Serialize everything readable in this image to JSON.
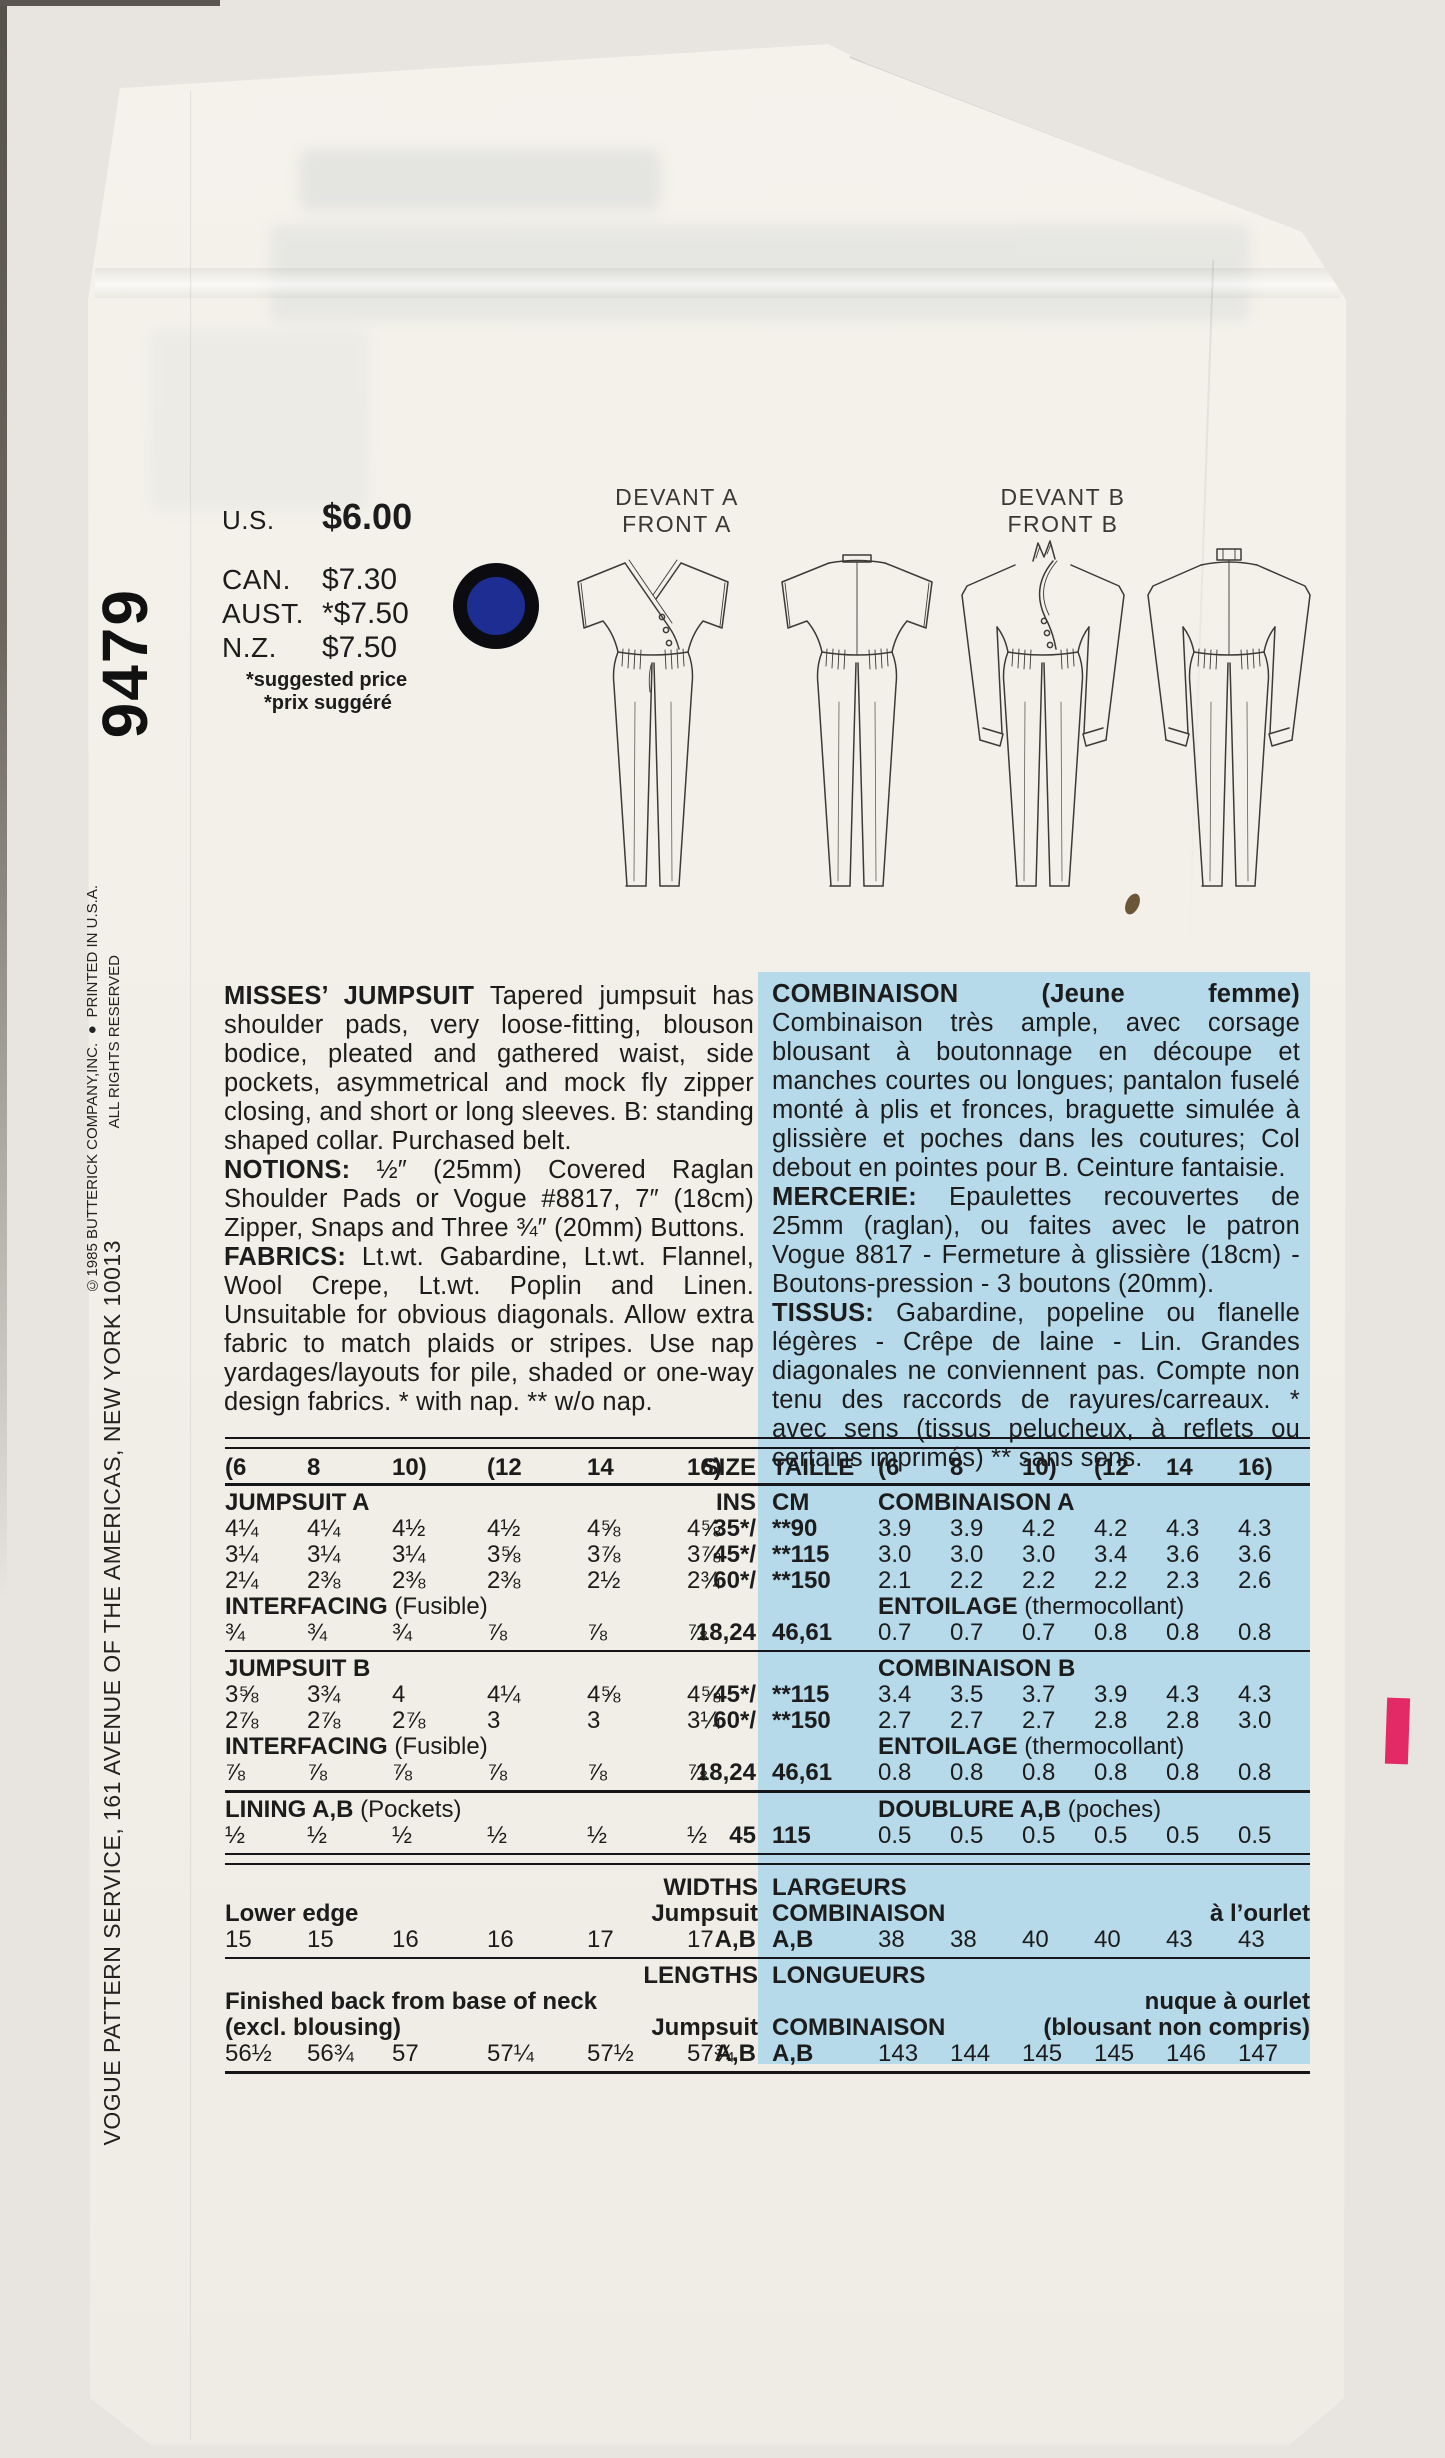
{
  "colors": {
    "scan_bg": "#e8e5e0",
    "paper": "#f2efe8",
    "blue_panel": "#b6daea",
    "ink": "#1c1c1c",
    "dot_blue": "#1d2d92",
    "pink_mark": "#e32a67"
  },
  "pattern": {
    "number": "9479"
  },
  "side": {
    "address": "VOGUE PATTERN SERVICE, 161 AVENUE OF THE AMERICAS, NEW YORK 10013",
    "copyright": "©1985 BUTTERICK COMPANY,INC. ● PRINTED IN U.S.A.",
    "rights": "ALL RIGHTS RESERVED"
  },
  "prices": {
    "us_label": "U.S.",
    "us": "$6.00",
    "can_label": "CAN.",
    "can": "$7.30",
    "aust_label": "AUST.",
    "aust": "*$7.50",
    "nz_label": "N.Z.",
    "nz": "$7.50",
    "note_en": "*suggested price",
    "note_fr": "*prix suggéré"
  },
  "figures": {
    "front_a_fr": "DEVANT A",
    "front_a_en": "FRONT A",
    "front_b_fr": "DEVANT B",
    "front_b_en": "FRONT B"
  },
  "description_en": {
    "p1_lead": "MISSES’ JUMPSUIT",
    "p1_text": " Tapered jumpsuit has shoulder pads, very loose-fitting, blouson bodice, pleated and gathered waist, side pockets, asymmetrical and mock fly zipper closing, and short or long sleeves. B: standing shaped collar. Purchased belt.",
    "p2_lead": "NOTIONS:",
    "p2_text": " ½″ (25mm) Covered Raglan Shoulder Pads or Vogue #8817, 7″ (18cm) Zipper, Snaps and Three ¾″ (20mm) Buttons.",
    "p3_lead": "FABRICS:",
    "p3_text": " Lt.wt. Gabardine, Lt.wt. Flannel, Wool Crepe, Lt.wt. Poplin and Linen. Unsuitable for obvious diagonals. Allow extra fabric to match plaids or stripes. Use nap yardages/layouts for pile, shaded or one-way design fabrics. * with nap. ** w/o nap."
  },
  "description_fr": {
    "p1_lead": "COMBINAISON (Jeune femme)",
    "p1_text": " Combinaison très ample, avec corsage blousant à boutonnage en découpe et manches courtes ou longues; pantalon fuselé monté à plis et fronces, braguette simulée à glissière et poches dans les coutures; Col debout en pointes pour B. Ceinture fantaisie.",
    "p2_lead": "MERCERIE:",
    "p2_text": " Epaulettes recouvertes de 25mm (raglan), ou faites avec le patron Vogue 8817 - Fermeture à glissière (18cm) - Boutons-pression - 3 boutons (20mm).",
    "p3_lead": "TISSUS:",
    "p3_text": " Gabardine, popeline ou flanelle légères - Crêpe de laine - Lin. Grandes diagonales ne conviennent pas. Compte non tenu des raccords de rayures/carreaux. * avec sens (tissus pelucheux, à reflets ou certains imprimés) ** sans sens."
  },
  "table": {
    "header": {
      "sizes_left": [
        "(6",
        "8",
        "10)",
        "(12",
        "14",
        "16)"
      ],
      "size_label": "SIZE",
      "taille_label": "TAILLE",
      "sizes_right": [
        "(6",
        "8",
        "10)",
        "(12",
        "14",
        "16)"
      ]
    },
    "jumpsuit_a": {
      "label_en": "JUMPSUIT A",
      "unit_en": "INS",
      "unit_fr": "CM",
      "label_fr": "COMBINAISON A",
      "rows": [
        {
          "ins": [
            "4¼",
            "4¼",
            "4½",
            "4½",
            "4⅝",
            "4⅝"
          ],
          "size": "35*/",
          "cm_size": "**90",
          "cm": [
            "3.9",
            "3.9",
            "4.2",
            "4.2",
            "4.3",
            "4.3"
          ]
        },
        {
          "ins": [
            "3¼",
            "3¼",
            "3¼",
            "3⅝",
            "3⅞",
            "3⅞"
          ],
          "size": "45*/",
          "cm_size": "**115",
          "cm": [
            "3.0",
            "3.0",
            "3.0",
            "3.4",
            "3.6",
            "3.6"
          ]
        },
        {
          "ins": [
            "2¼",
            "2⅜",
            "2⅜",
            "2⅜",
            "2½",
            "2¾"
          ],
          "size": "60*/",
          "cm_size": "**150",
          "cm": [
            "2.1",
            "2.2",
            "2.2",
            "2.2",
            "2.3",
            "2.6"
          ]
        }
      ],
      "interfacing_en_lead": "INTERFACING",
      "interfacing_en_rest": " (Fusible)",
      "interfacing_fr_lead": "ENTOILAGE",
      "interfacing_fr_rest": " (thermocollant)",
      "interfacing_row": {
        "ins": [
          "¾",
          "¾",
          "¾",
          "⅞",
          "⅞",
          "⅞"
        ],
        "size": "18,24",
        "cm_size": "46,61",
        "cm": [
          "0.7",
          "0.7",
          "0.7",
          "0.8",
          "0.8",
          "0.8"
        ]
      }
    },
    "jumpsuit_b": {
      "label_en": "JUMPSUIT B",
      "label_fr": "COMBINAISON B",
      "rows": [
        {
          "ins": [
            "3⅝",
            "3¾",
            "4",
            "4¼",
            "4⅝",
            "4⅝"
          ],
          "size": "45*/",
          "cm_size": "**115",
          "cm": [
            "3.4",
            "3.5",
            "3.7",
            "3.9",
            "4.3",
            "4.3"
          ]
        },
        {
          "ins": [
            "2⅞",
            "2⅞",
            "2⅞",
            "3",
            "3",
            "3¼"
          ],
          "size": "60*/",
          "cm_size": "**150",
          "cm": [
            "2.7",
            "2.7",
            "2.7",
            "2.8",
            "2.8",
            "3.0"
          ]
        }
      ],
      "interfacing_en_lead": "INTERFACING",
      "interfacing_en_rest": " (Fusible)",
      "interfacing_fr_lead": "ENTOILAGE",
      "interfacing_fr_rest": " (thermocollant)",
      "interfacing_row": {
        "ins": [
          "⅞",
          "⅞",
          "⅞",
          "⅞",
          "⅞",
          "⅞"
        ],
        "size": "18,24",
        "cm_size": "46,61",
        "cm": [
          "0.8",
          "0.8",
          "0.8",
          "0.8",
          "0.8",
          "0.8"
        ]
      }
    },
    "lining": {
      "label_en_lead": "LINING A,B",
      "label_en_rest": " (Pockets)",
      "label_fr_lead": "DOUBLURE A,B",
      "label_fr_rest": " (poches)",
      "row": {
        "ins": [
          "½",
          "½",
          "½",
          "½",
          "½",
          "½"
        ],
        "size": "45",
        "cm_size": "115",
        "cm": [
          "0.5",
          "0.5",
          "0.5",
          "0.5",
          "0.5",
          "0.5"
        ]
      }
    },
    "widths": {
      "title_en": "WIDTHS",
      "title_fr": "LARGEURS",
      "row_label_en": "Lower edge",
      "garment_en": "Jumpsuit",
      "garment_fr": "COMBINAISON",
      "hem_fr": "à l’ourlet",
      "values_in": [
        "15",
        "15",
        "16",
        "16",
        "17",
        "17"
      ],
      "ab_left": "A,B",
      "ab_right": "A,B",
      "values_cm": [
        "38",
        "38",
        "40",
        "40",
        "43",
        "43"
      ]
    },
    "lengths": {
      "title_en": "LENGTHS",
      "title_fr": "LONGUEURS",
      "row_label_en1": "Finished back from base of neck",
      "row_label_en2": "(excl. blousing)",
      "garment_en": "Jumpsuit",
      "garment_fr": "COMBINAISON",
      "note_fr1": "nuque à ourlet",
      "note_fr2": "(blousant non compris)",
      "values_in": [
        "56½",
        "56¾",
        "57",
        "57¼",
        "57½",
        "57¾"
      ],
      "ab_left": "A,B",
      "ab_right": "A,B",
      "values_cm": [
        "143",
        "144",
        "145",
        "145",
        "146",
        "147"
      ]
    }
  }
}
